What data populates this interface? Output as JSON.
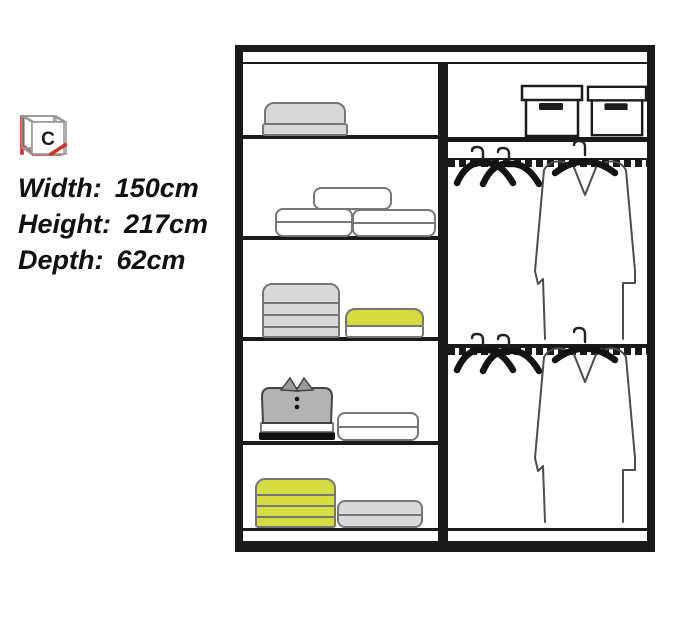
{
  "info_panel": {
    "variants": [
      "A",
      "B",
      "C"
    ],
    "dimensions": [
      {
        "label": "Width:",
        "value": "150cm"
      },
      {
        "label": "Height:",
        "value": "217cm"
      },
      {
        "label": "Depth:",
        "value": "62cm"
      }
    ]
  },
  "colors": {
    "frame": "#1a1a1a",
    "item-gray": "#d9d9d9",
    "item-yellow": "#d4dc40",
    "polo-gray": "#b3b3b3",
    "accent-red": "#c0392b"
  }
}
